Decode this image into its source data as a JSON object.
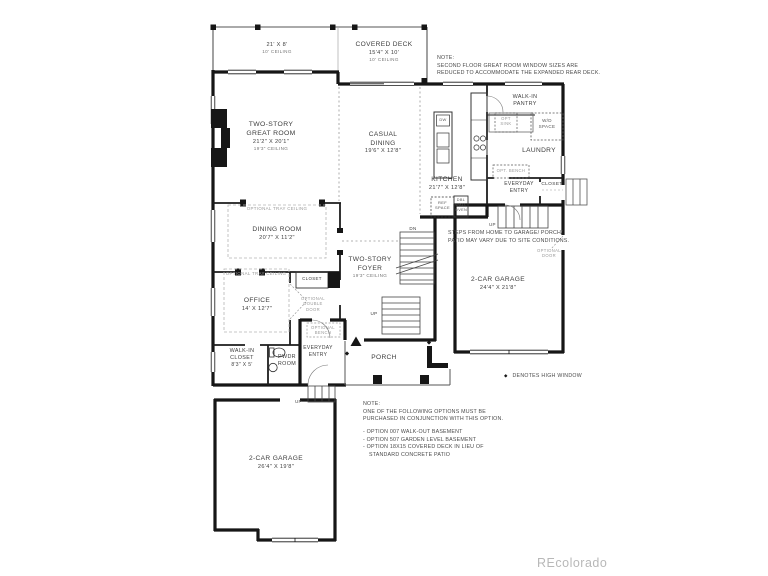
{
  "watermark": "REcolorado",
  "legend": {
    "symbol": "◆",
    "text": "DENOTES HIGH WINDOW"
  },
  "colors": {
    "wall": "#1a1a1a",
    "optional_gray": "#999999",
    "watermark_gray": "#b8b8b8"
  },
  "rooms": {
    "deck": [
      "21' X 8'",
      "10' CEILING"
    ],
    "covered_deck": [
      "COVERED DECK",
      "15'4\" X 10'",
      "10' CEILING"
    ],
    "great_room": [
      "TWO-STORY",
      "GREAT ROOM",
      "21'2\" X 20'1\"",
      "19'3\" CEILING"
    ],
    "casual_dining": [
      "CASUAL",
      "DINING",
      "19'6\" X 12'8\""
    ],
    "kitchen": [
      "KITCHEN",
      "21'7\" X 12'8\""
    ],
    "pantry": [
      "WALK-IN",
      "PANTRY"
    ],
    "laundry": [
      "LAUNDRY"
    ],
    "everyday_entry": [
      "EVERYDAY",
      "ENTRY"
    ],
    "closet": [
      "CLOSET"
    ],
    "garage_right": [
      "2-CAR GARAGE",
      "24'4\" X 21'8\""
    ],
    "dining_room": [
      "DINING ROOM",
      "20'7\" X 11'2\""
    ],
    "foyer": [
      "TWO-STORY",
      "FOYER",
      "19'3\" CEILING"
    ],
    "office": [
      "OFFICE",
      "14' X 12'7\""
    ],
    "walk_in_closet": [
      "WALK-IN",
      "CLOSET",
      "8'3\" X 5'"
    ],
    "pwdr": [
      "PWDR",
      "ROOM"
    ],
    "porch": [
      "PORCH"
    ],
    "garage_left": [
      "2-CAR GARAGE",
      "26'4\" X 19'8\""
    ]
  },
  "fixtures": {
    "dw": "DW",
    "ref_space": [
      "REF",
      "SPACE"
    ],
    "wall_oven": [
      "DBL",
      "WALL",
      "OVEN"
    ],
    "wd_space": [
      "W/D",
      "SPACE"
    ],
    "opt_sink": [
      "OPT",
      "SINK"
    ],
    "opt_bench": "OPT. BENCH",
    "optional_bench": [
      "OPTIONAL",
      "BENCH"
    ],
    "optional_double_door": [
      "OPTIONAL",
      "DOUBLE",
      "DOOR"
    ],
    "optional_door": [
      "OPTIONAL",
      "DOOR"
    ],
    "optional_tray_ceiling": "OPTIONAL TRAY CEILING",
    "up": "UP",
    "dn": "DN"
  },
  "notes": {
    "top": [
      "NOTE:",
      "SECOND FLOOR GREAT ROOM WINDOW SIZES ARE",
      "REDUCED TO ACCOMMODATE THE EXPANDED REAR DECK."
    ],
    "steps": [
      "STEPS FROM HOME TO GARAGE/ PORCH/",
      "PATIO MAY VARY DUE TO SITE CONDITIONS."
    ],
    "bottom": [
      "NOTE:",
      "ONE OF THE FOLLOWING OPTIONS MUST BE",
      "PURCHASED IN CONJUNCTION WITH THIS OPTION.",
      "- OPTION 007 WALK-OUT BASEMENT",
      "- OPTION 507 GARDEN LEVEL BASEMENT",
      "- OPTION 18X15 COVERED DECK IN LIEU OF",
      "STANDARD CONCRETE PATIO"
    ]
  }
}
